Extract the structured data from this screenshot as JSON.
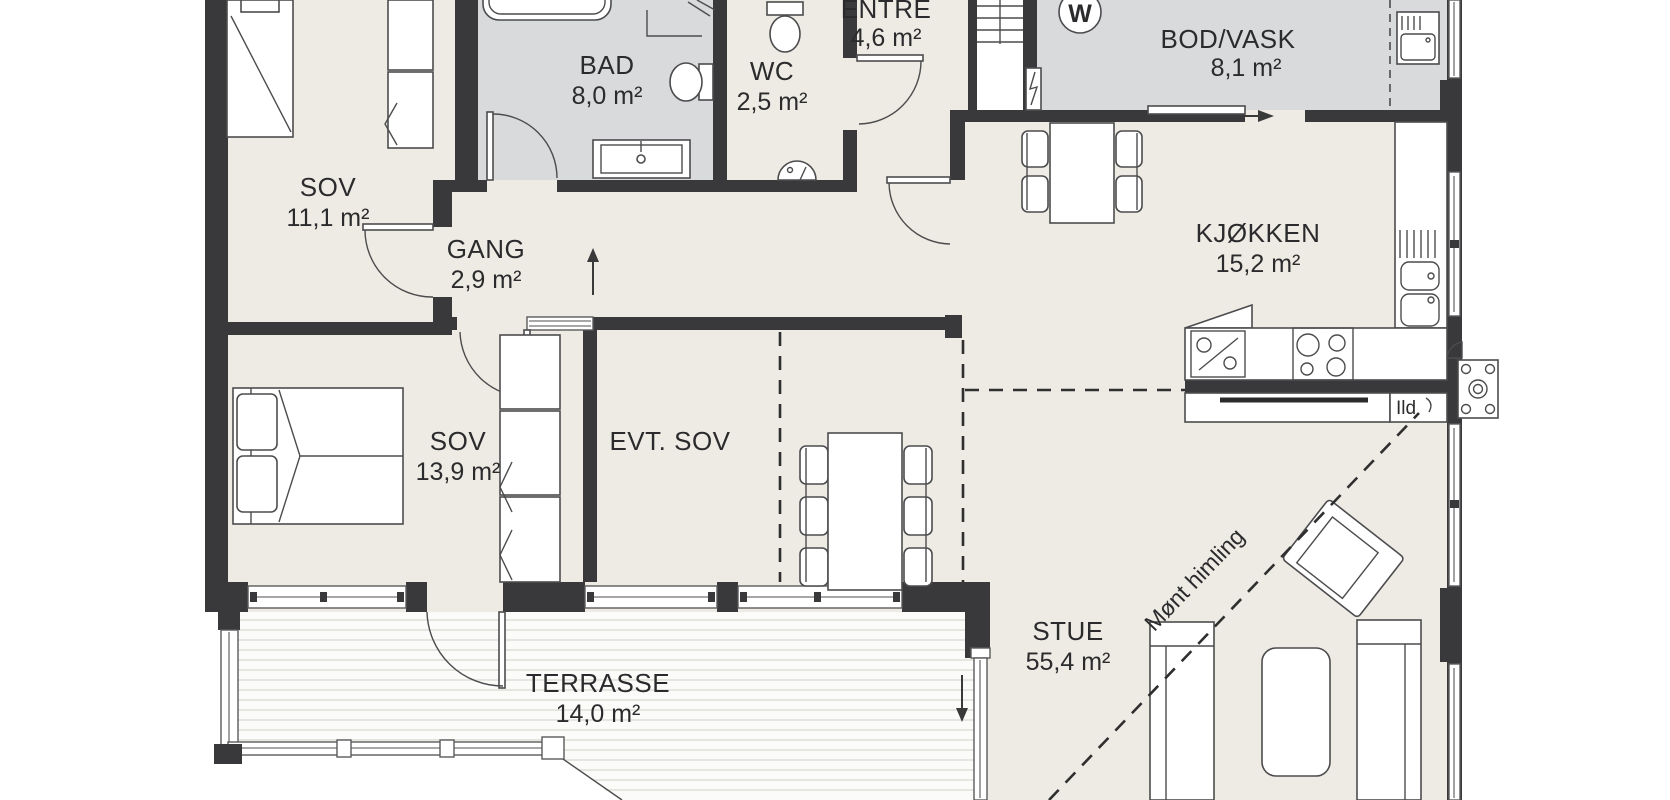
{
  "plan": {
    "rooms": [
      {
        "name": "SOV",
        "area": "11,1 m²"
      },
      {
        "name": "BAD",
        "area": "8,0 m²"
      },
      {
        "name": "WC",
        "area": "2,5 m²"
      },
      {
        "name": "ENTRE",
        "area": "4,6 m²"
      },
      {
        "name": "BOD/VASK",
        "area": "8,1 m²"
      },
      {
        "name": "GANG",
        "area": "2,9 m²"
      },
      {
        "name": "KJØKKEN",
        "area": "15,2 m²"
      },
      {
        "name": "SOV",
        "area": "13,9 m²"
      },
      {
        "name": "EVT. SOV",
        "area": ""
      },
      {
        "name": "STUE",
        "area": "55,4 m²"
      },
      {
        "name": "TERRASSE",
        "area": "14,0 m²"
      }
    ],
    "annotations": {
      "washer_label": "W",
      "fireplace_label": "Ild",
      "ridge_label": "Mønt himling"
    },
    "colors": {
      "wall": "#39393b",
      "floor": "#edebe3",
      "wet_room": "#d9dadc",
      "deck": "#fbfbf9"
    }
  }
}
